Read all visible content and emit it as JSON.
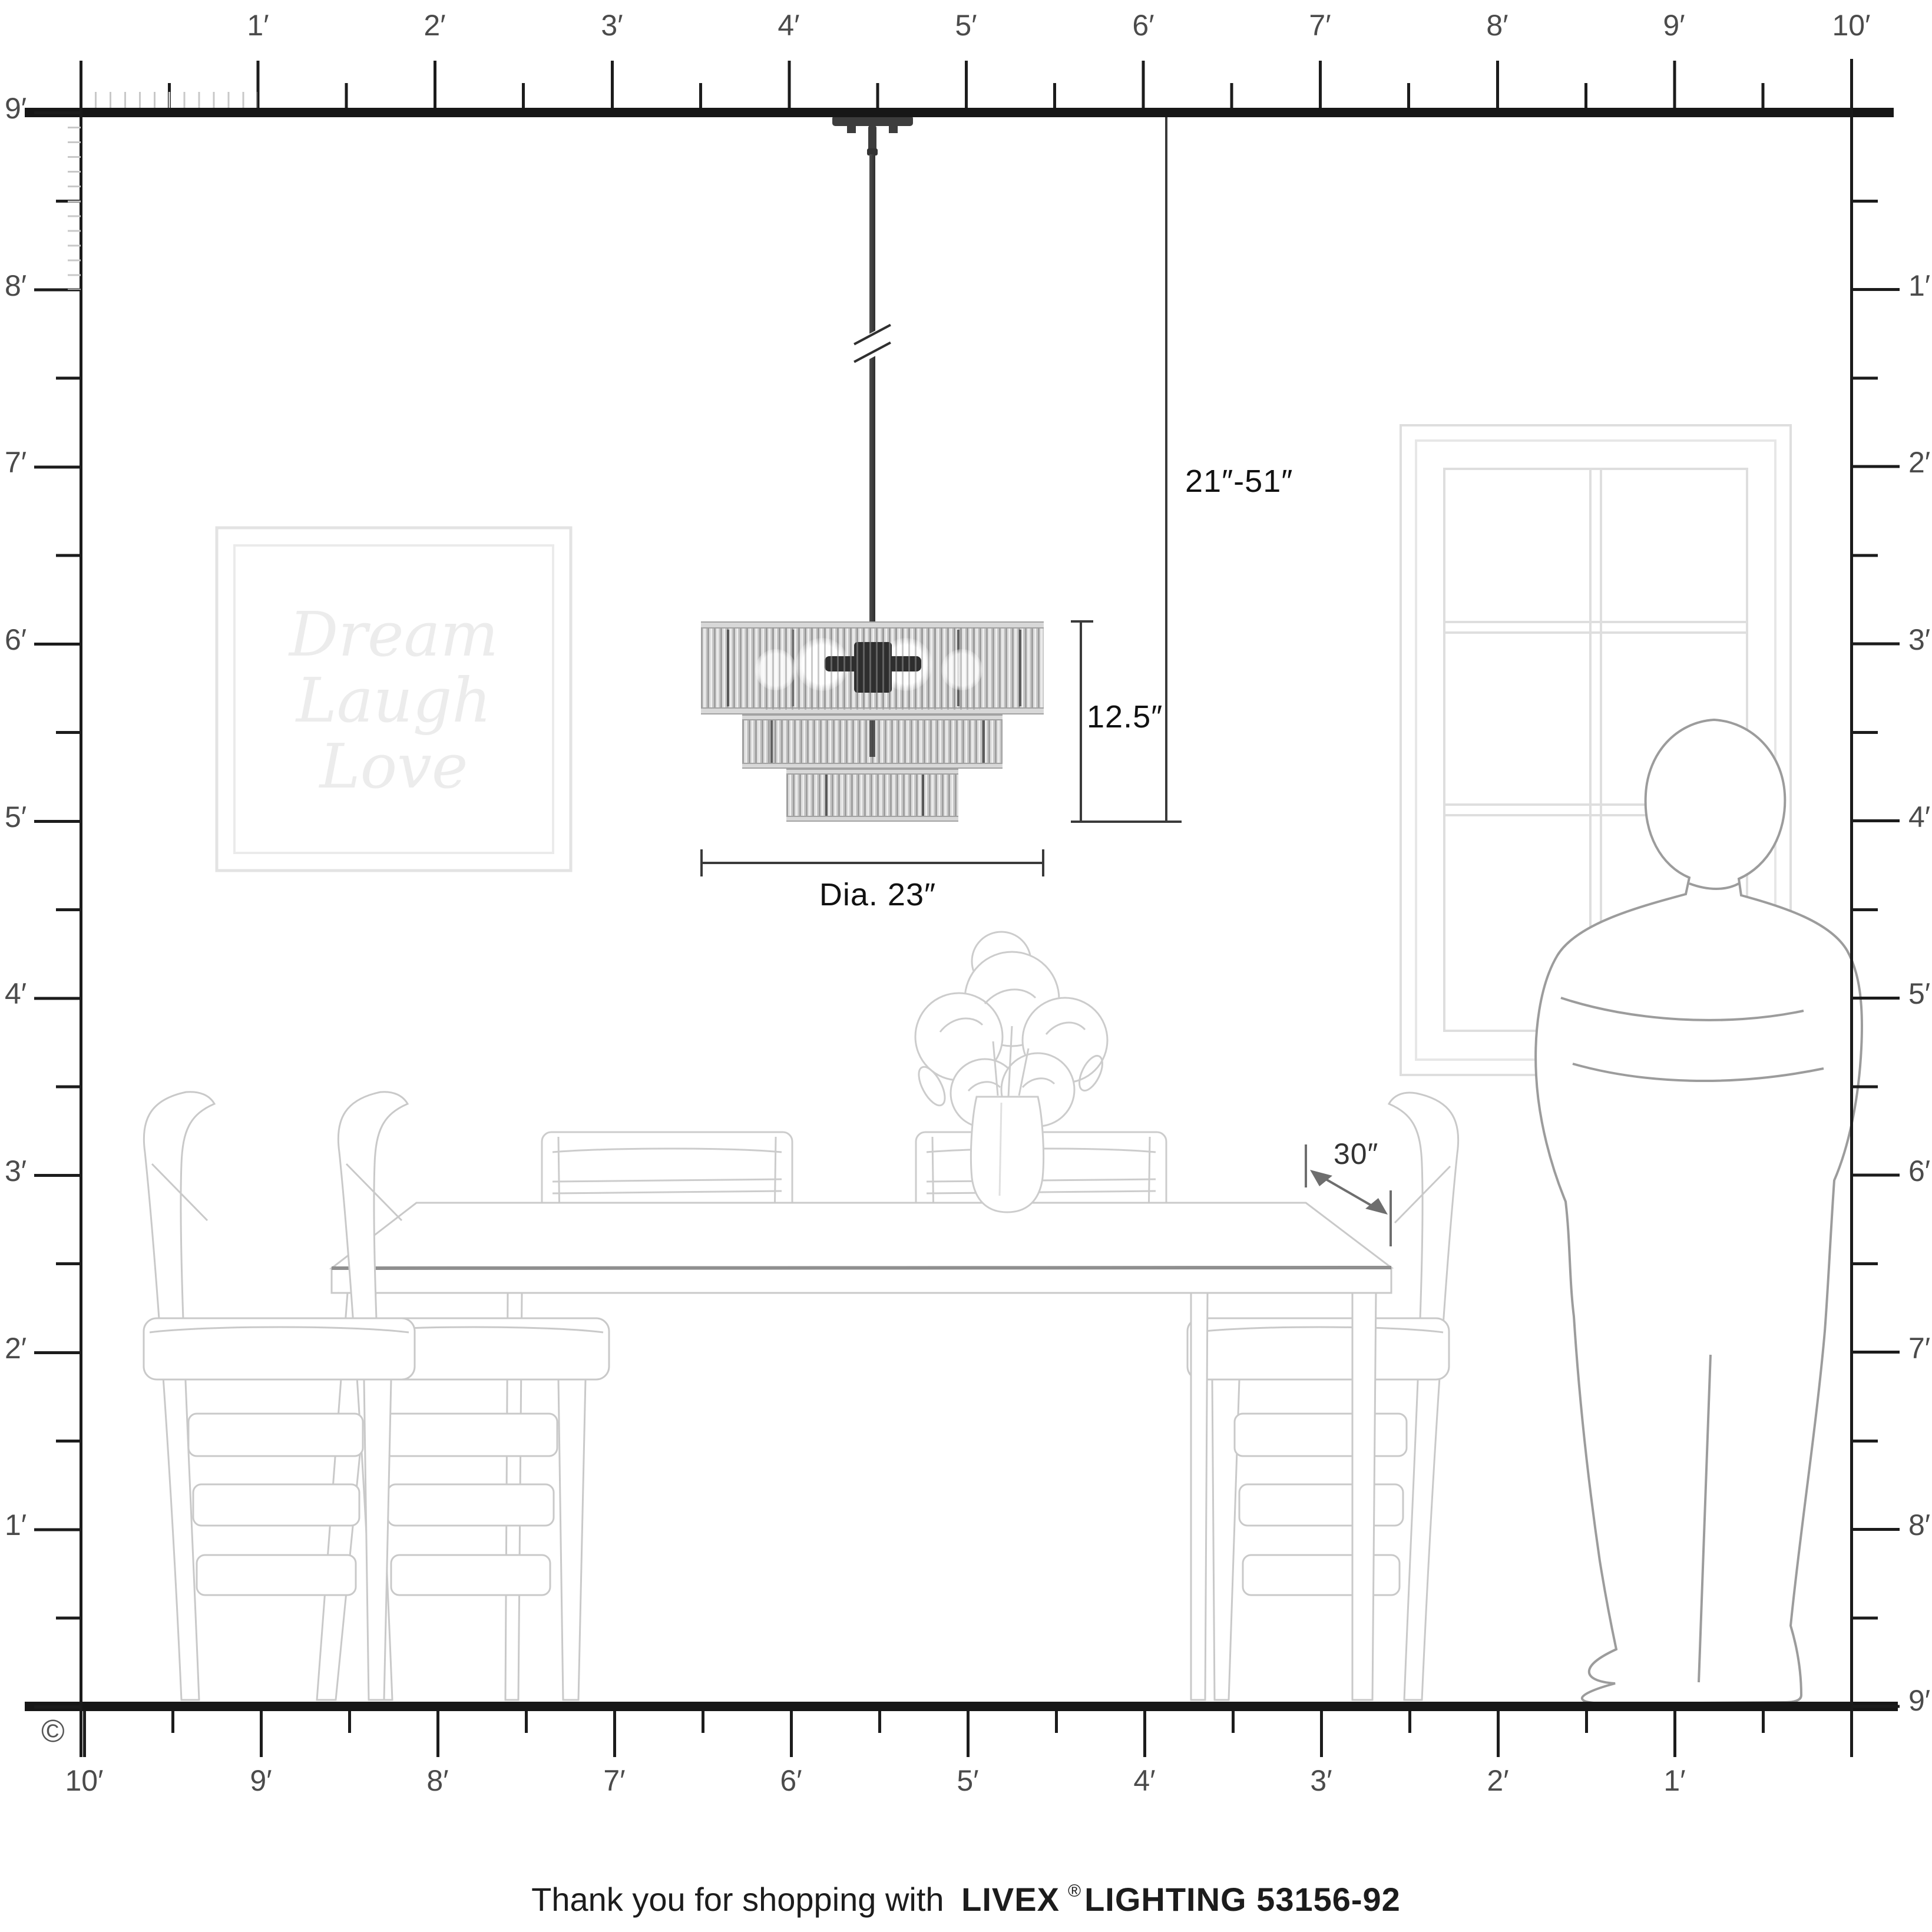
{
  "rulers": {
    "top": [
      "1′",
      "2′",
      "3′",
      "4′",
      "5′",
      "6′",
      "7′",
      "8′",
      "9′",
      "10′"
    ],
    "bottom": [
      "10′",
      "9′",
      "8′",
      "7′",
      "6′",
      "5′",
      "4′",
      "3′",
      "2′",
      "1′"
    ],
    "left": [
      "9′",
      "8′",
      "7′",
      "6′",
      "5′",
      "4′",
      "3′",
      "2′",
      "1′"
    ],
    "right": [
      "1′",
      "2′",
      "3′",
      "4′",
      "5′",
      "6′",
      "7′",
      "8′",
      "9′"
    ]
  },
  "annotations": {
    "hanging_range": "21″-51″",
    "fixture_height": "12.5″",
    "fixture_diameter": "Dia. 23″",
    "table_depth": "30″"
  },
  "wall_art": {
    "line1": "Dream",
    "line2": "Laugh",
    "line3": "Love"
  },
  "copyright": "©",
  "footer": {
    "prefix": "Thank you for shopping with",
    "brand": "LIVEX",
    "registered": "®",
    "suffix": "LIGHTING 53156-92"
  },
  "colors": {
    "ink": "#1b1b1b",
    "ruler_text": "#4b4b4b",
    "fine_tick": "#c8c8c8",
    "furniture_line": "#c9c9c9",
    "table_edge": "#8f8f8f",
    "window_line": "#dedede",
    "person_line": "#9c9c9c",
    "art_text": "#ececec",
    "metal": "#3d3d3d",
    "shade_light": "#dedede",
    "shade_dark": "#9f9f9f"
  }
}
